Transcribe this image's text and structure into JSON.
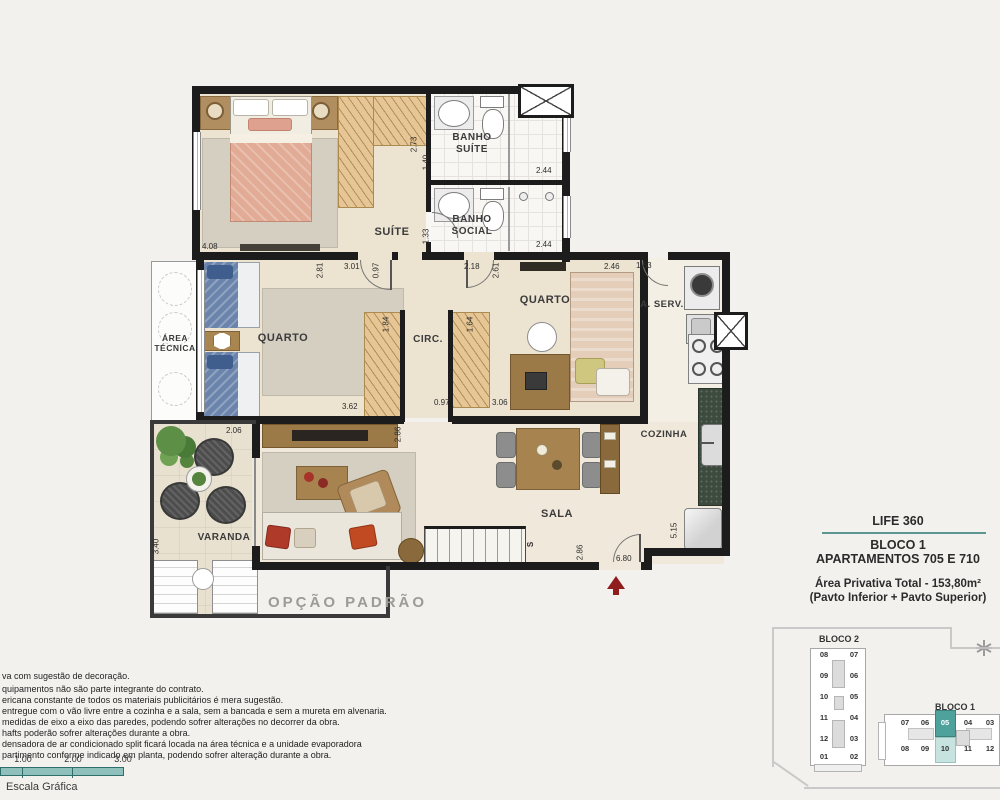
{
  "plan": {
    "option_label": "OPÇÃO PADRÃO",
    "rooms": {
      "suite": "SUÍTE",
      "banho_suite": "BANHO\nSUÍTE",
      "banho_social": "BANHO\nSOCIAL",
      "quarto1": "QUARTO",
      "quarto2": "QUARTO",
      "circ": "CIRC.",
      "area_tecnica": "ÁREA\nTÉCNICA",
      "aserv": "A. SERV.",
      "cozinha": "COZINHA",
      "sala": "SALA",
      "varanda": "VARANDA",
      "stairs": "S"
    },
    "dims": {
      "suite_w": "4.08",
      "banho_suite_d": "2.73",
      "banho_suite_w": "1.40",
      "banho_suite_shower": "2.44",
      "banho_social_w": "1.33",
      "banho_social_shower": "2.44",
      "quarto1_d": "2.81",
      "hall_w": "3.01",
      "hall_d": "0.97",
      "quarto2_hall": "2.18",
      "quarto2_d": "2.61",
      "quarto2_top": "2.46",
      "aserv_w": "1.63",
      "closet1_w": "1.84",
      "closet2_w": "1.64",
      "quarto1_w": "3.62",
      "circ_w": "0.97",
      "quarto2_w": "3.06",
      "varanda_w": "2.06",
      "varanda_d": "3.40",
      "sala_tv": "2.86",
      "sala_entry": "2.86",
      "entry_w": "6.80",
      "cozinha_d": "5.15"
    }
  },
  "info": {
    "brand": "LIFE 360",
    "block": "BLOCO 1",
    "apartments": "APARTAMENTOS 705 E 710",
    "area": "Área Privativa Total - 153,80m²",
    "floors": "(Pavto Inferior + Pavto Superior)"
  },
  "keyplan": {
    "bloco2": {
      "label": "BLOCO 2",
      "left_col": [
        "08",
        "09",
        "10",
        "11",
        "12",
        "01"
      ],
      "right_col": [
        "07",
        "06",
        "05",
        "04",
        "03",
        "02"
      ]
    },
    "bloco1": {
      "label": "BLOCO 1",
      "top_row": [
        "07",
        "06",
        "05",
        "04",
        "03"
      ],
      "bottom_row": [
        "08",
        "09",
        "10",
        "11",
        "12"
      ],
      "highlight_top": "05",
      "highlight_bottom": "10"
    }
  },
  "notes": {
    "lines": [
      "va com sugestão de decoração.",
      "quipamentos não são parte integrante do contrato.",
      "ericana constante de todos os materiais publicitários é mera sugestão.",
      "entregue com o vão livre entre a cozinha e a sala, sem a bancada e sem a mureta em alvenaria.",
      "medidas de eixo a eixo das paredes, podendo sofrer alterações no decorrer da obra.",
      "hafts poderão sofrer alterações durante a obra.",
      "densadora de ar condicionado split ficará locada na área técnica e a unidade evaporadora",
      "partimento conforme indicado em planta, podendo sofrer alteração durante a obra."
    ]
  },
  "scale": {
    "ticks": [
      "1.00",
      "2.00",
      "3.00"
    ],
    "label": "Escala Gráfica"
  },
  "colors": {
    "accent_teal": "#5b9894",
    "keyplan_highlight_dark": "#4fa29c",
    "keyplan_highlight_light": "#c6e3df",
    "entry_arrow": "#8f1d1d",
    "wall": "#1c1c1c",
    "floor_beige": "#ece3d1"
  }
}
